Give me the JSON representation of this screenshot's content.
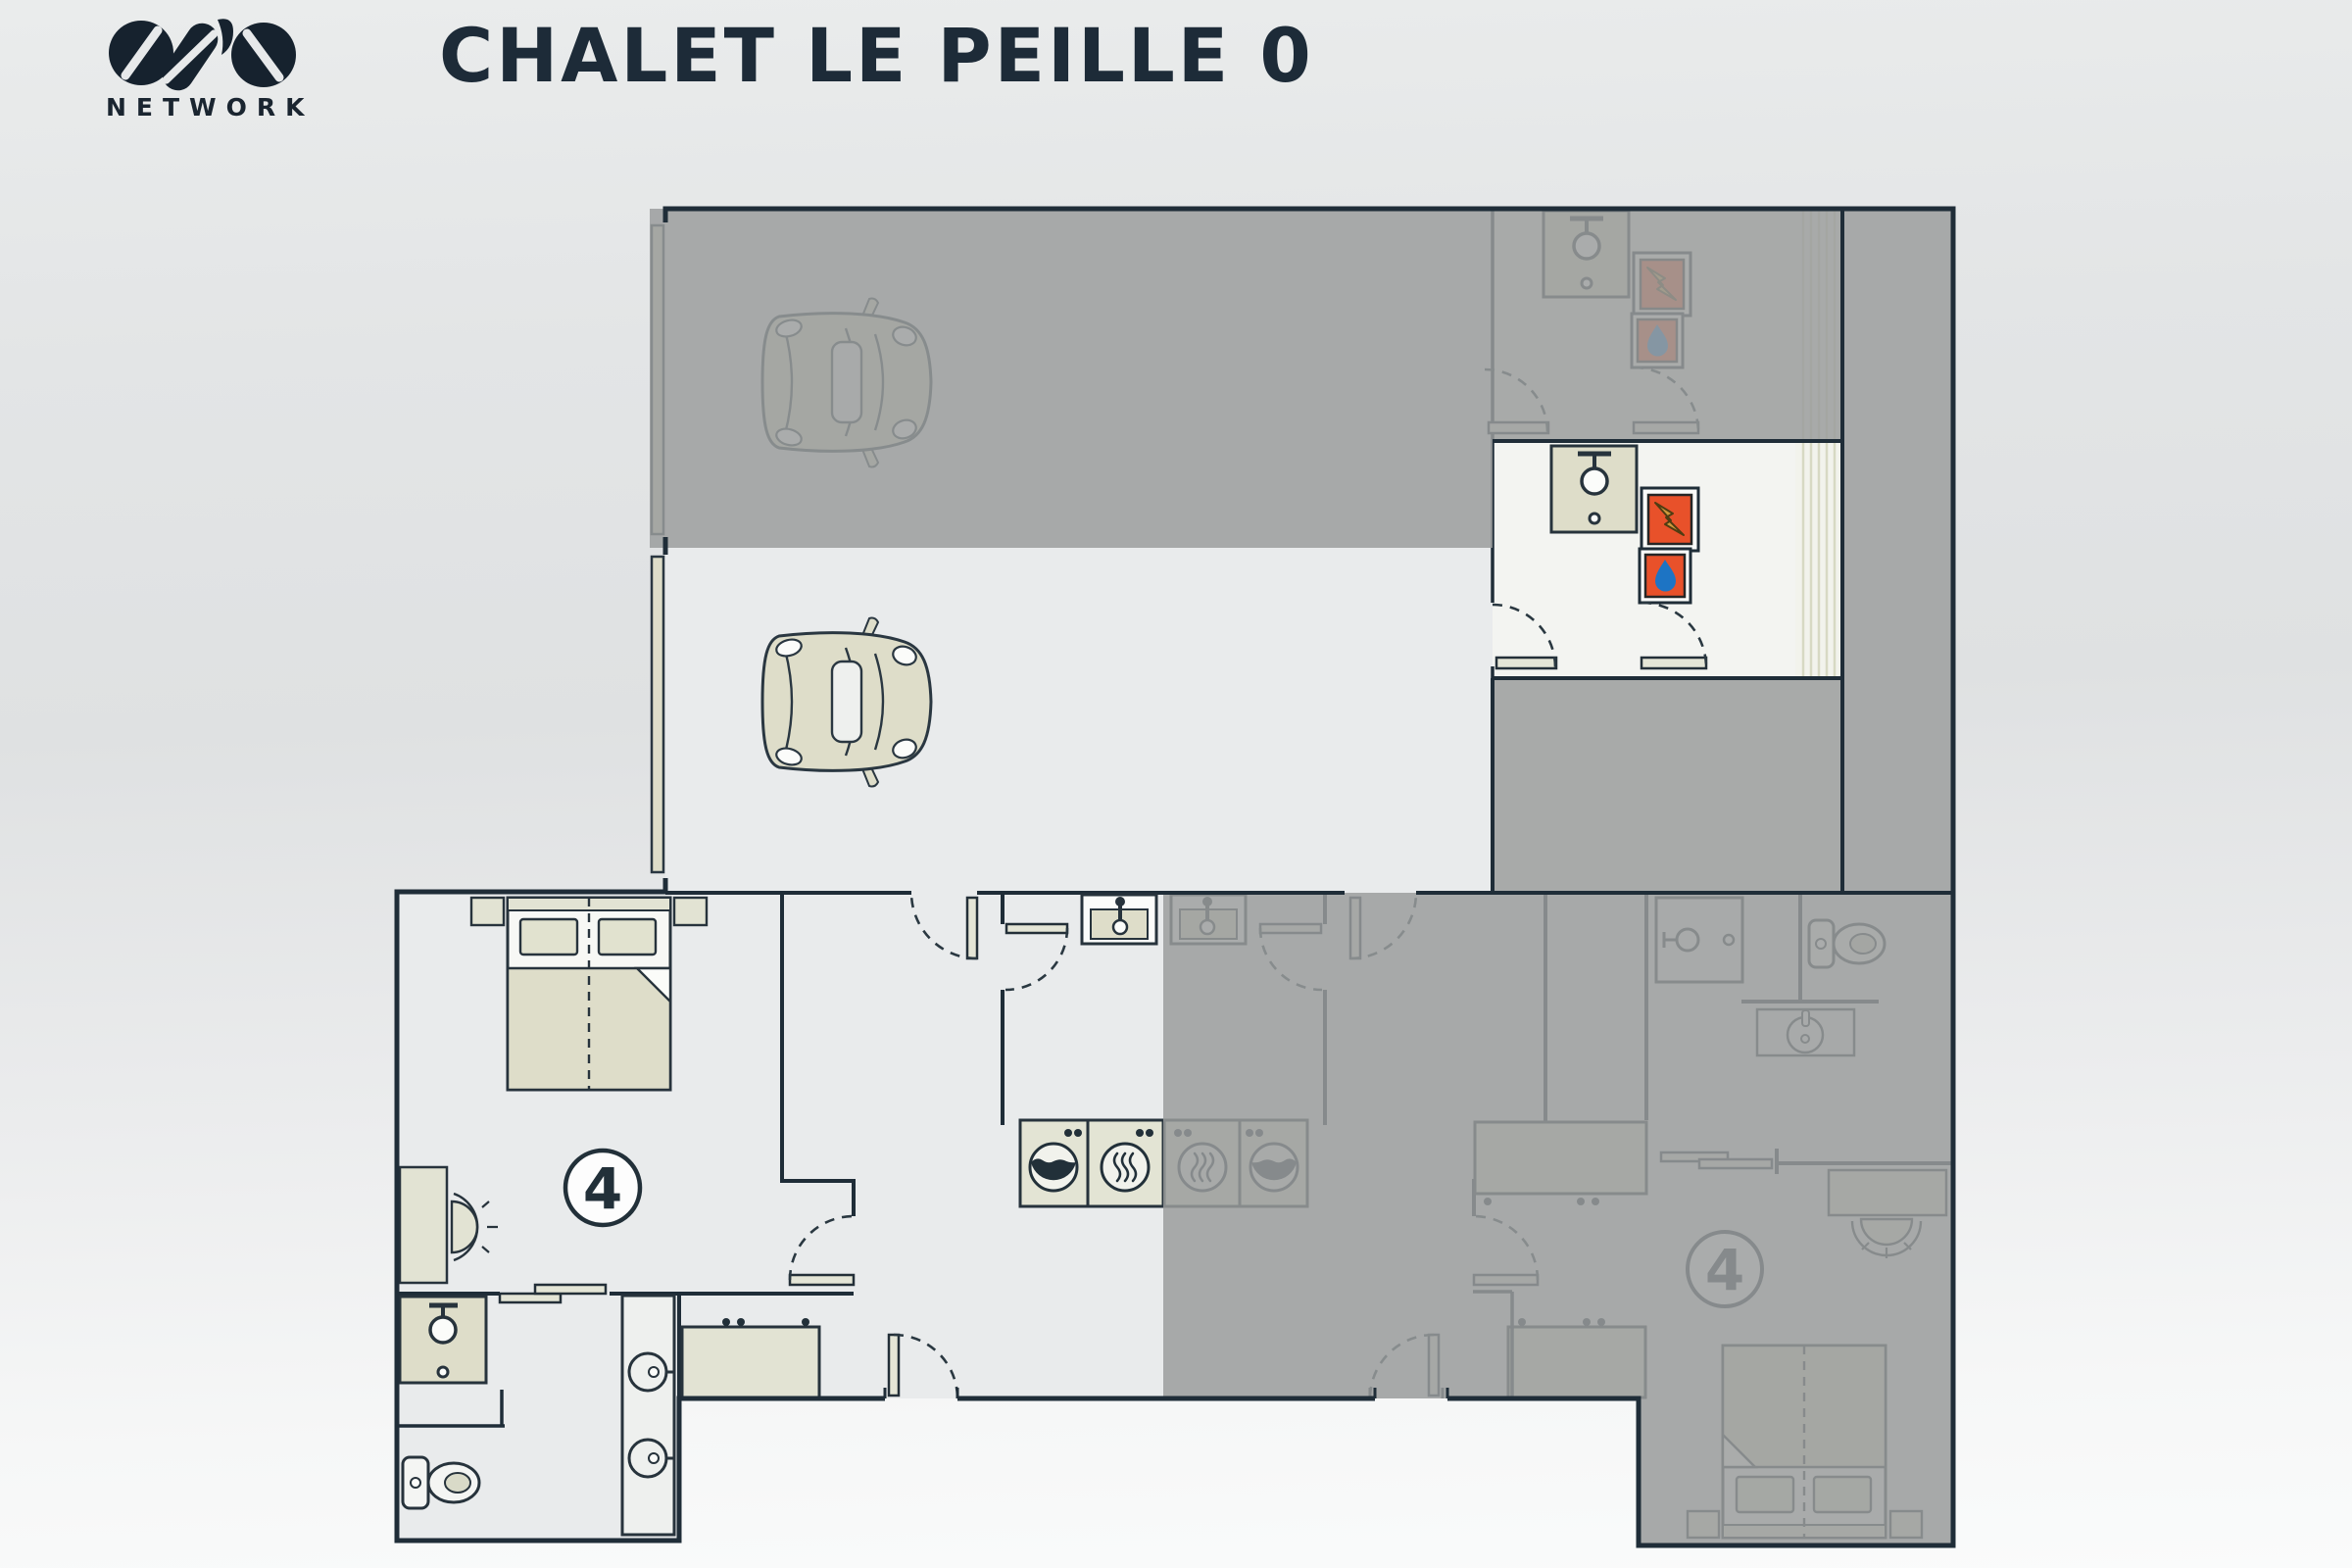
{
  "header": {
    "brand": "OVO",
    "brand_sub": "NETWORK",
    "title": "CHALET LE PEILLE 0"
  },
  "plan": {
    "active_bedroom_badge": "4",
    "faded_bedroom_badge": "4",
    "floor_level_shown": "0",
    "colors": {
      "wall_ink": "#1F2D38",
      "active_floor": "#E9EBEC",
      "utility_floor": "#F3F4F1",
      "furniture_beige": "#DEDDC9",
      "faded_overlay_gray": "#9A9C9C",
      "accent_orange": "#E8512A",
      "bolt_gold": "#CF9A3C",
      "water_drop_blue": "#1D74C4",
      "title_ink": "#1D2B38"
    },
    "icons": [
      "car-icon",
      "bed-icon",
      "pillow-icon",
      "nightstand-icon",
      "desk-icon",
      "chair-icon",
      "sink-icon",
      "toilet-icon",
      "shower-icon",
      "vanity-basin-icon",
      "washing-machine-icon",
      "tumble-dryer-icon",
      "electrical-panel-icon",
      "water-heater-icon",
      "stairs-icon",
      "door-swing-icon",
      "sliding-door-icon",
      "garage-door-icon",
      "coat-hooks-icon",
      "bench-icon",
      "wardrobe-cabinet-icon",
      "capacity-badge-icon"
    ]
  }
}
